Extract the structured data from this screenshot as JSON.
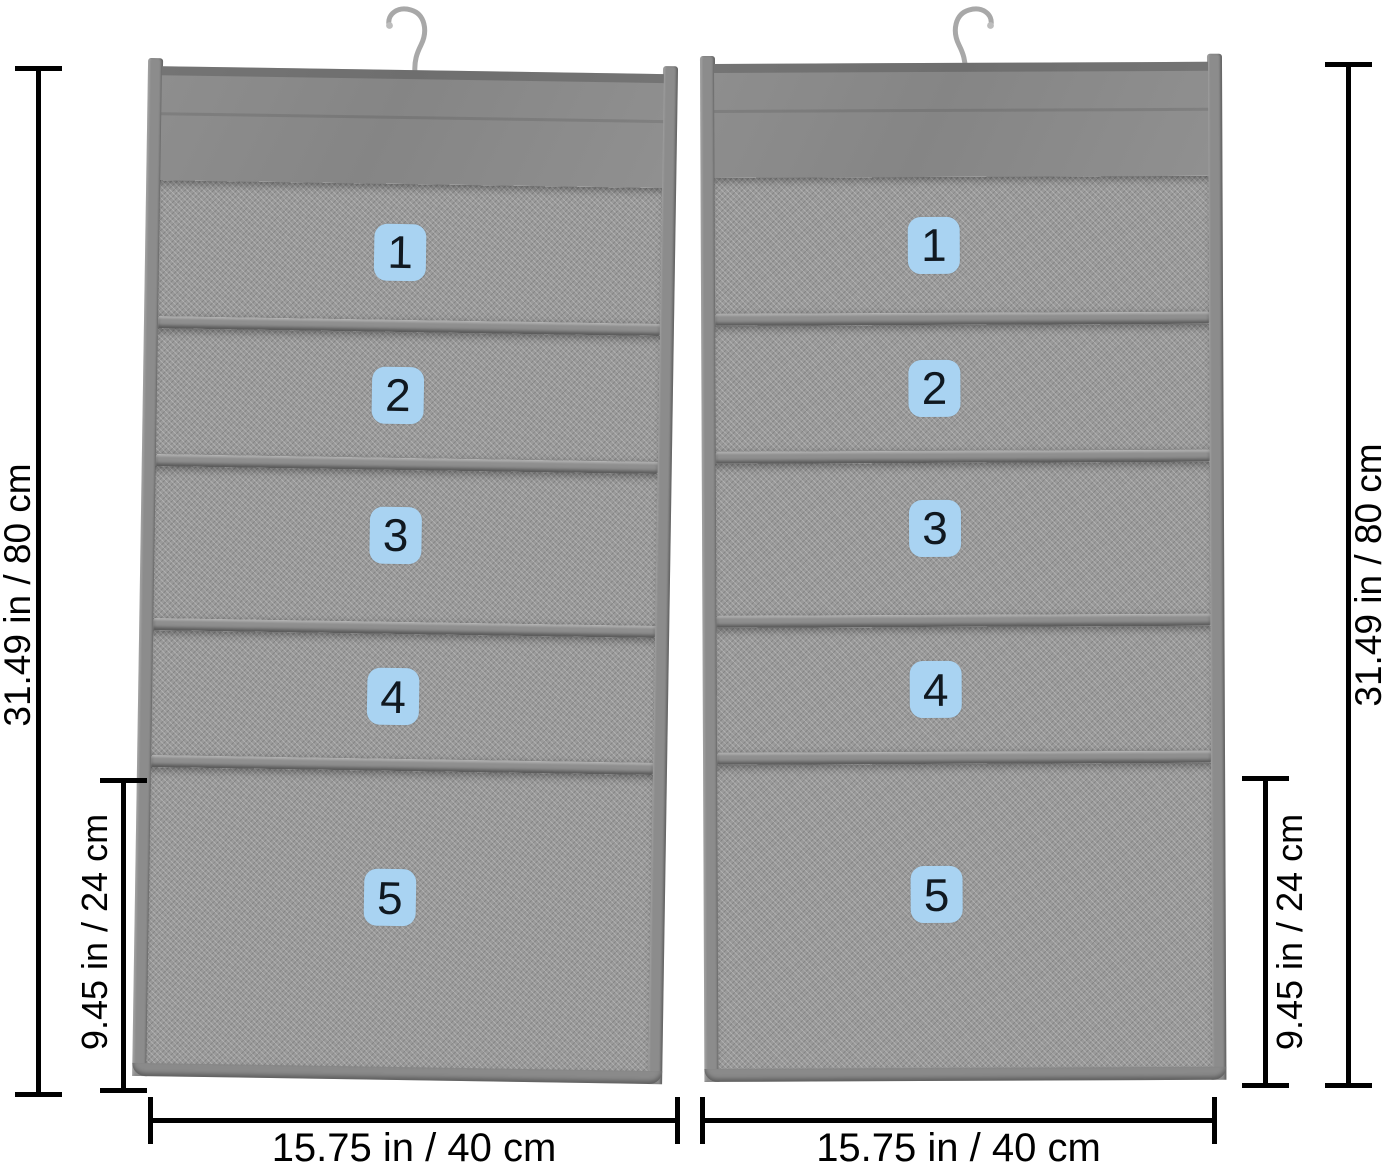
{
  "icons": {
    "left_hook": "hanger-hook",
    "right_hook": "hanger-hook"
  },
  "colors": {
    "background": "#ffffff",
    "fabric": "#8a8a8a",
    "mesh": "#9a9a9a",
    "badge_bg": "#a9d3f2",
    "badge_text": "#101820",
    "dimension_line": "#000000",
    "hook_metal": "#a8a8a8"
  },
  "organizers": [
    {
      "position": "left",
      "pockets": [
        {
          "label": "1"
        },
        {
          "label": "2"
        },
        {
          "label": "3"
        },
        {
          "label": "4"
        },
        {
          "label": "5"
        }
      ]
    },
    {
      "position": "right",
      "pockets": [
        {
          "label": "1"
        },
        {
          "label": "2"
        },
        {
          "label": "3"
        },
        {
          "label": "4"
        },
        {
          "label": "5"
        }
      ]
    }
  ],
  "dimensions": {
    "left_height": "31.49 in / 80 cm",
    "right_height": "31.49 in / 80 cm",
    "left_bottom_pocket_height": "9.45 in / 24 cm",
    "right_bottom_pocket_height": "9.45 in / 24 cm",
    "left_width": "15.75 in / 40 cm",
    "right_width": "15.75 in / 40 cm"
  }
}
